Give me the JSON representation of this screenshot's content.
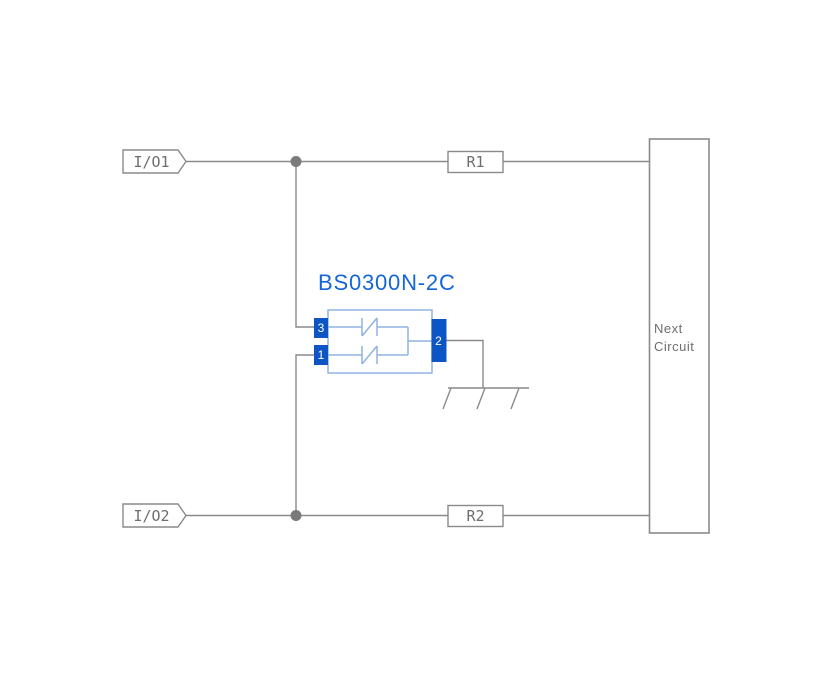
{
  "schematic": {
    "component": {
      "title": "BS0300N-2C",
      "pins": {
        "pin1": "1",
        "pin2": "2",
        "pin3": "3"
      }
    },
    "io_tags": {
      "io1": "I/O1",
      "io2": "I/O2"
    },
    "resistors": {
      "r1": "R1",
      "r2": "R2"
    },
    "next_circuit": {
      "line1": "Next",
      "line2": "Circuit"
    },
    "colors": {
      "wire_gray": "#8a8a8a",
      "label_gray": "#6e6e6e",
      "junction_dot_gray": "#7a7a7a",
      "component_outline_blue": "#8fb3e2",
      "pin_fill_blue": "#0d55c4",
      "title_blue": "#1566d8",
      "background": "#ffffff"
    }
  }
}
